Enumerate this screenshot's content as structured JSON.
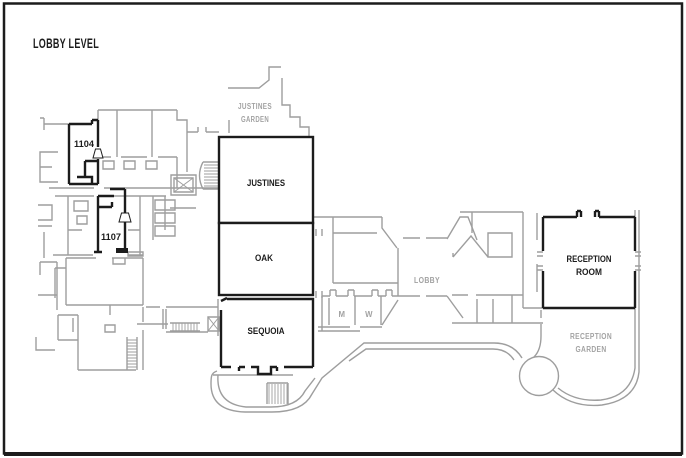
{
  "title": "LOBBY LEVEL",
  "rooms": {
    "justines": {
      "label": "JUSTINES"
    },
    "oak": {
      "label": "OAK"
    },
    "sequoia": {
      "label": "SEQUOIA"
    },
    "reception_room": {
      "label": [
        "RECEPTION",
        "ROOM"
      ]
    },
    "room_1104": {
      "label": "1104"
    },
    "room_1107": {
      "label": "1107"
    }
  },
  "areas": {
    "lobby": {
      "label": "LOBBY"
    },
    "justines_garden": {
      "label": [
        "JUSTINES",
        "GARDEN"
      ]
    },
    "reception_garden": {
      "label": [
        "RECEPTION",
        "GARDEN"
      ]
    },
    "mens_restroom": {
      "label": "M"
    },
    "womens_restroom": {
      "label": "W"
    }
  },
  "colors": {
    "primary_wall": "#1c1c1c",
    "secondary_wall": "#9e9e9e",
    "muted_label": "#a2a2a2",
    "background": "#ffffff"
  }
}
